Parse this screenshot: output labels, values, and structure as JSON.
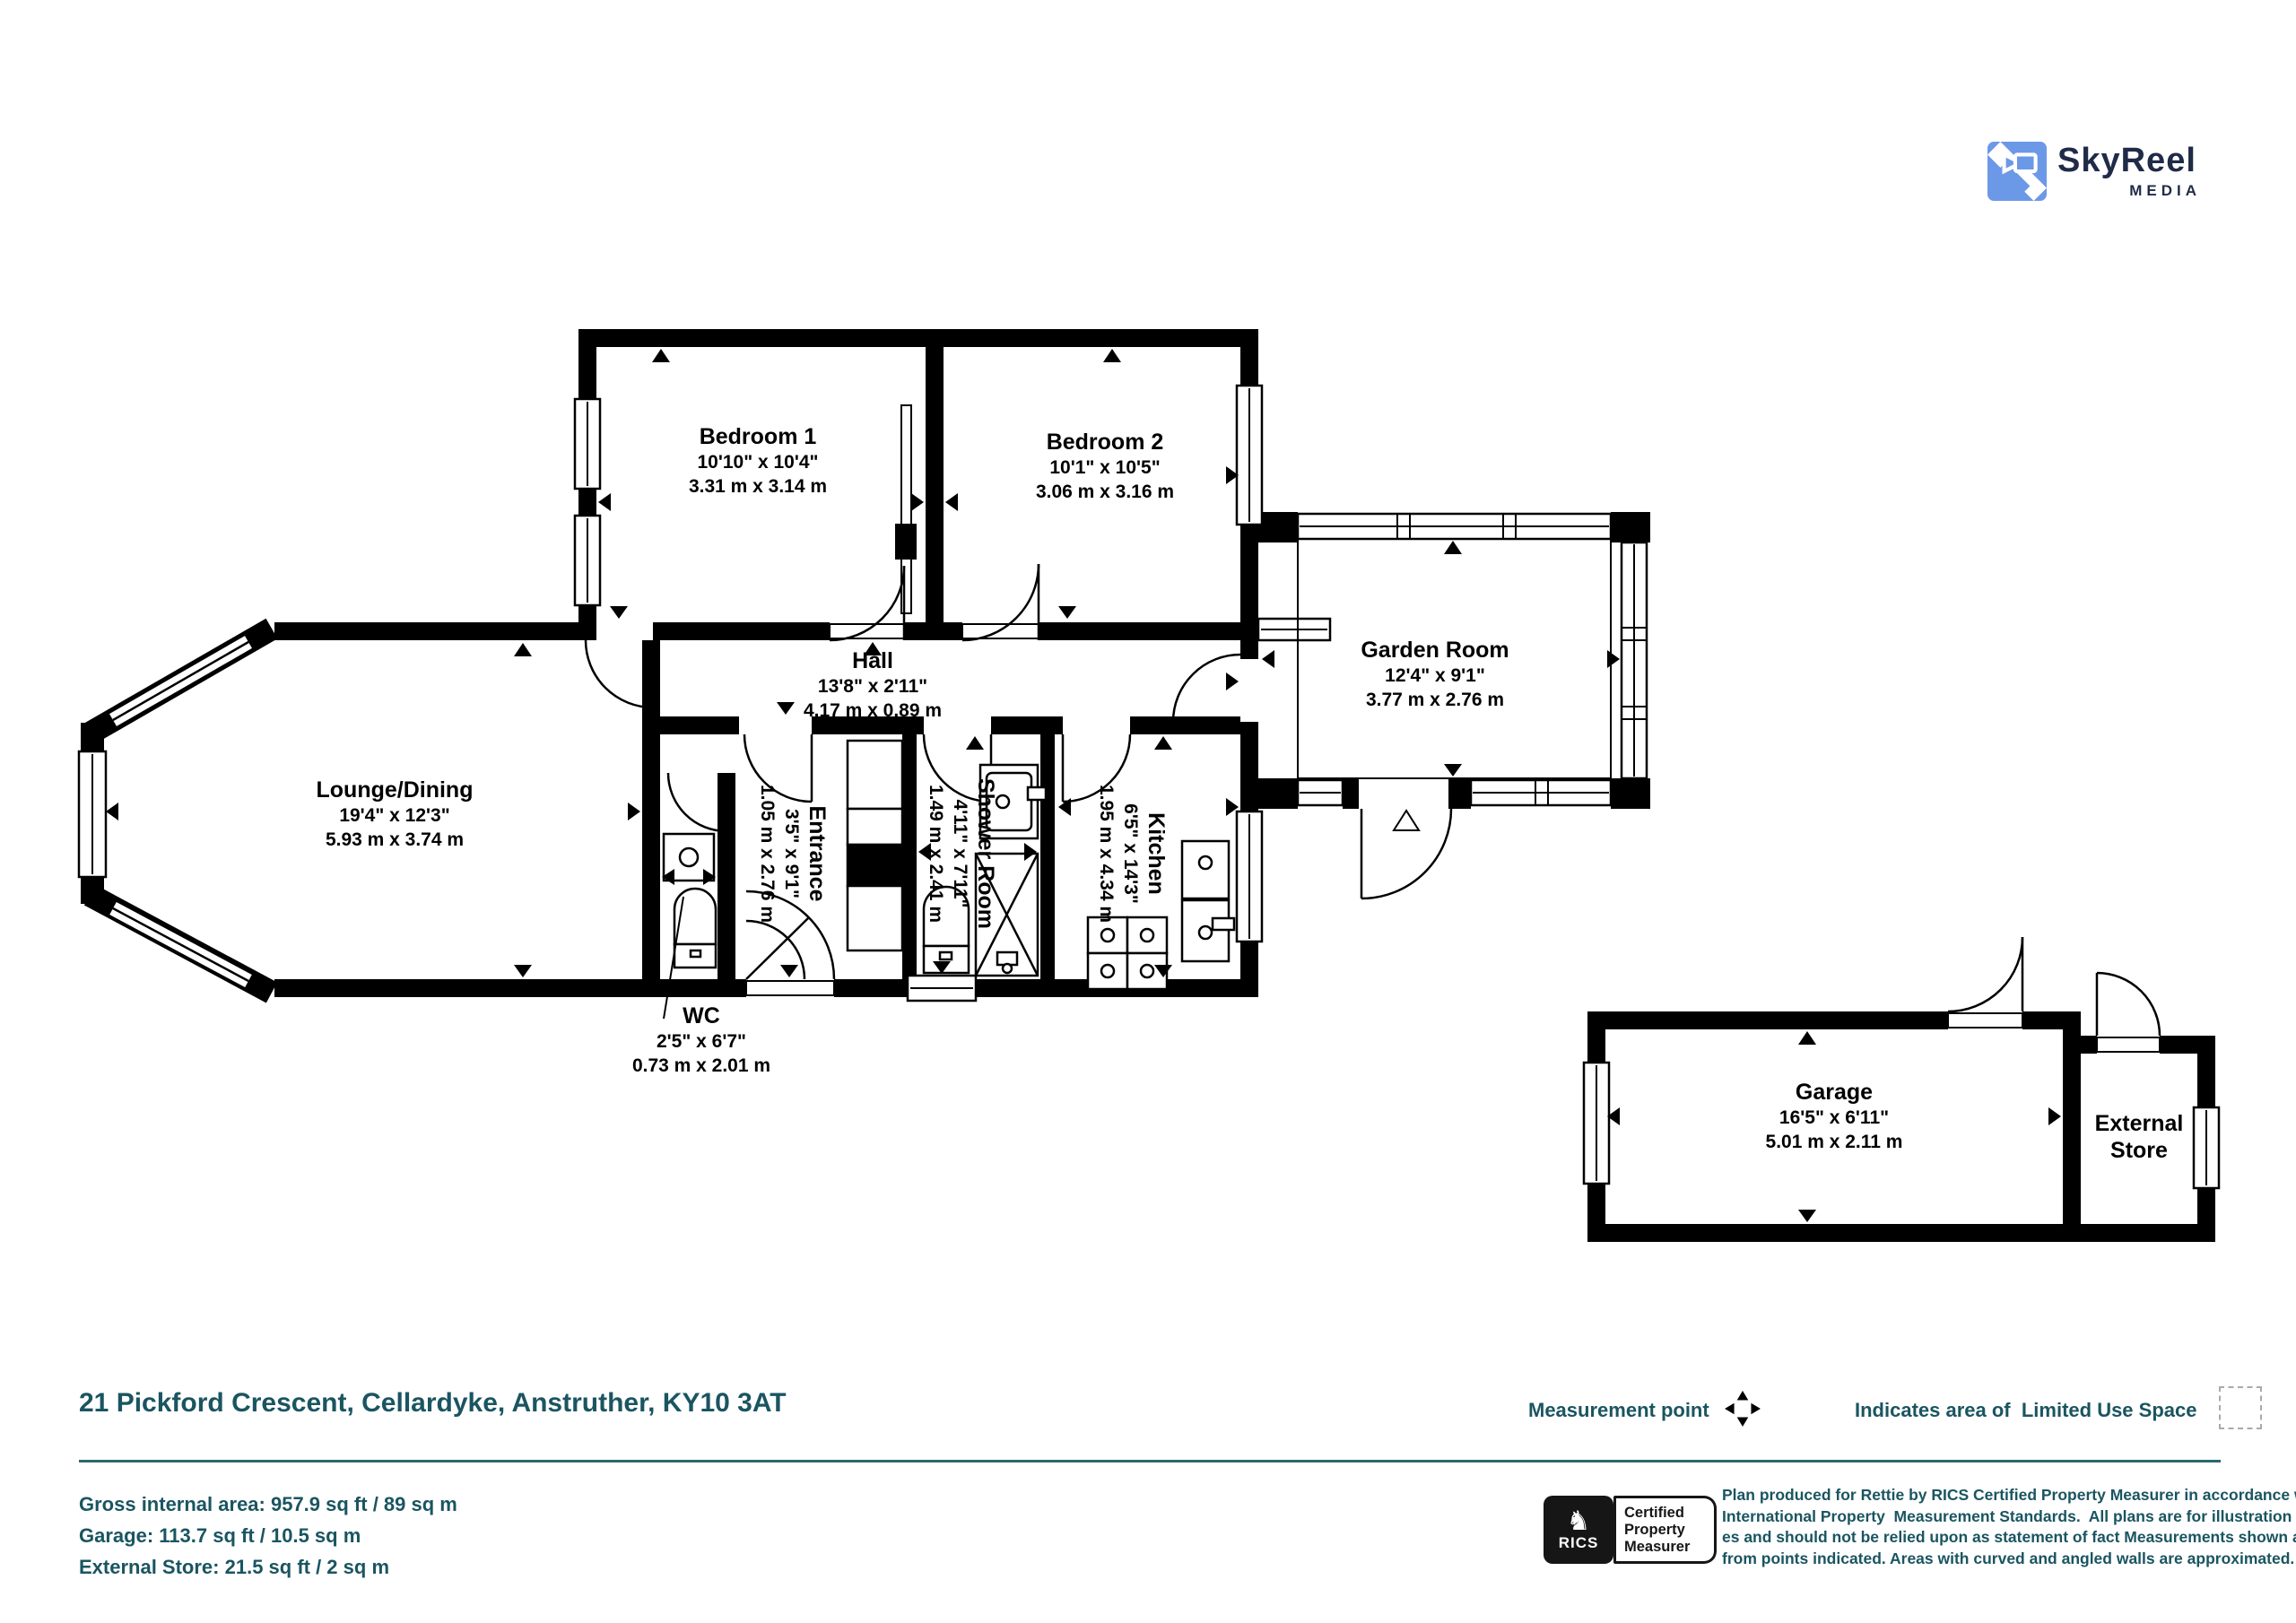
{
  "logo": {
    "brand": "SkyReel",
    "brand_sub": "MEDIA"
  },
  "colors": {
    "teal": "#1A5561",
    "plan_black": "#000000",
    "logo_blue": "#6C98E8",
    "logo_navy": "#1F2B47"
  },
  "rooms": {
    "bedroom1": {
      "label": "Bedroom 1",
      "imperial": "10'10\" x 10'4\"",
      "metric": "3.31 m x 3.14 m"
    },
    "bedroom2": {
      "label": "Bedroom 2",
      "imperial": "10'1\" x 10'5\"",
      "metric": "3.06 m x 3.16 m"
    },
    "garden_room": {
      "label": "Garden Room",
      "imperial": "12'4\" x 9'1\"",
      "metric": "3.77 m x 2.76 m"
    },
    "lounge": {
      "label": "Lounge/Dining",
      "imperial": "19'4\" x 12'3\"",
      "metric": "5.93 m x 3.74 m"
    },
    "hall": {
      "label": "Hall",
      "imperial": "13'8\" x 2'11\"",
      "metric": "4.17 m x 0.89 m"
    },
    "entrance": {
      "label": "Entrance",
      "imperial": "3'5\" x 9'1\"",
      "metric": "1.05 m x 2.76 m"
    },
    "shower_room": {
      "label": "Shower Room",
      "imperial": "4'11\" x 7'11\"",
      "metric": "1.49 m x 2.41 m"
    },
    "kitchen": {
      "label": "Kitchen",
      "imperial": "6'5\" x 14'3\"",
      "metric": "1.95 m x 4.34 m"
    },
    "wc": {
      "label": "WC",
      "imperial": "2'5\" x 6'7\"",
      "metric": "0.73 m x 2.01 m"
    },
    "garage": {
      "label": "Garage",
      "imperial": "16'5\" x 6'11\"",
      "metric": "5.01 m x 2.11 m"
    },
    "external_store": {
      "label_line1": "External",
      "label_line2": "Store"
    }
  },
  "footer": {
    "address": "21 Pickford Crescent, Cellardyke, Anstruther, KY10 3AT",
    "area_line1": "Gross internal area: 957.9 sq ft / 89 sq m",
    "area_line2": "Garage: 113.7 sq ft / 10.5 sq m",
    "area_line3": "External Store: 21.5 sq ft / 2 sq m",
    "legend_measurement": "Measurement point",
    "legend_limited": "Indicates area of  Limited Use Space",
    "rics_acronym": "RICS",
    "rics_line1": "Certified",
    "rics_line2": "Property",
    "rics_line3": "Measurer",
    "disclaimer_line1": "Plan produced for Rettie by RICS Certified Property Measurer in accordance with RICS",
    "disclaimer_line2": "International Property  Measurement Standards.  All plans are for illustration purpos-",
    "disclaimer_line3": "es and should not be relied upon as statement of fact Measurements shown are taken",
    "disclaimer_line4": "from points indicated. Areas with curved and angled walls are approximated."
  }
}
